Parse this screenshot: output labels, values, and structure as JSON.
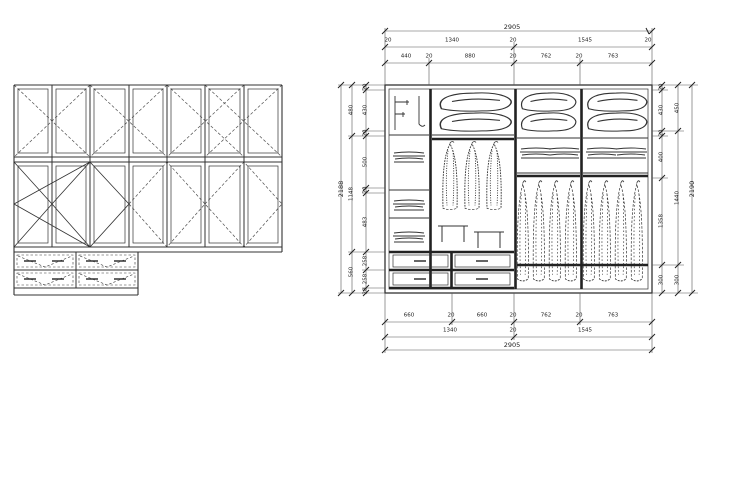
{
  "drawing": {
    "type": "cad-wardrobe-elevation",
    "views": {
      "front_elevation": "wardrobe front elevation with door swing marks and drawers",
      "internal_elevation": "wardrobe internal layout with shelves, hanging rails and drawers"
    },
    "line_color": "#333333",
    "background": "#ffffff"
  },
  "symbols": {
    "pillow": "pillow-icon",
    "folded_clothes": "folded-clothes-icon",
    "hanging_garment": "hanging-garment-icon",
    "hook_panel": "hook-panel-icon",
    "shelf_bracket": "shelf-bracket-icon",
    "drawer_front": "drawer-front-icon"
  },
  "dims": {
    "top": {
      "total": "2905",
      "row2": [
        "20",
        "1340",
        "20",
        "1545",
        "20"
      ],
      "row3": [
        "440",
        "20",
        "880",
        "20",
        "762",
        "20",
        "763"
      ]
    },
    "bottom": {
      "row1": [
        "660",
        "20",
        "660",
        "20",
        "762",
        "20",
        "763"
      ],
      "row2": [
        "1340",
        "20",
        "1545"
      ],
      "total": "2905"
    },
    "left": {
      "inner": [
        "20",
        "430",
        "20",
        "500",
        "20",
        "483",
        "258",
        "258",
        "20"
      ],
      "mid": [
        "480",
        "1148",
        "560"
      ],
      "total": "2188"
    },
    "right": {
      "inner": [
        "20",
        "430",
        "20",
        "400",
        "1358",
        "300"
      ],
      "mid": [
        "450",
        "1440",
        "300"
      ],
      "total": "2190"
    }
  }
}
